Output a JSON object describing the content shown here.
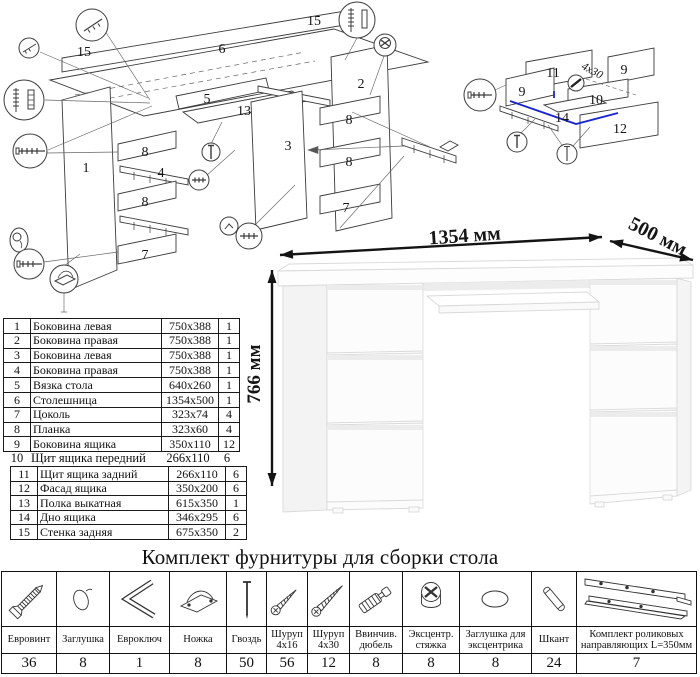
{
  "main_diagram": {
    "labels": [
      "15",
      "6",
      "15",
      "1",
      "8",
      "4",
      "8",
      "7",
      "5",
      "13",
      "3",
      "2",
      "8",
      "8",
      "7"
    ]
  },
  "drawer_diagram": {
    "labels": [
      "9",
      "11",
      "9",
      "10",
      "14",
      "12"
    ],
    "screw_note": "4x30"
  },
  "desk": {
    "width_label": "1354 мм",
    "depth_label": "500 мм",
    "height_label": "766 мм"
  },
  "parts_table": {
    "rows": [
      {
        "num": "1",
        "name": "Боковина левая",
        "size": "750x388",
        "qty": "1"
      },
      {
        "num": "2",
        "name": "Боковина правая",
        "size": "750x388",
        "qty": "1"
      },
      {
        "num": "3",
        "name": "Боковина левая",
        "size": "750x388",
        "qty": "1"
      },
      {
        "num": "4",
        "name": "Боковина правая",
        "size": "750x388",
        "qty": "1"
      },
      {
        "num": "5",
        "name": "Вязка стола",
        "size": "640x260",
        "qty": "1"
      },
      {
        "num": "6",
        "name": "Столешница",
        "size": "1354x500",
        "qty": "1"
      },
      {
        "num": "7",
        "name": "Цоколь",
        "size": "323x74",
        "qty": "4"
      },
      {
        "num": "8",
        "name": "Планка",
        "size": "323x60",
        "qty": "4"
      },
      {
        "num": "9",
        "name": "Боковина ящика",
        "size": "350x110",
        "qty": "12"
      },
      {
        "num": "10",
        "name": "Щит ящика передний",
        "size": "266x110",
        "qty": "6"
      },
      {
        "num": "11",
        "name": "Щит ящика задний",
        "size": "266x110",
        "qty": "6"
      },
      {
        "num": "12",
        "name": "Фасад ящика",
        "size": "350x200",
        "qty": "6"
      },
      {
        "num": "13",
        "name": "Полка выкатная",
        "size": "615x350",
        "qty": "1"
      },
      {
        "num": "14",
        "name": "Дно ящика",
        "size": "346x295",
        "qty": "6"
      },
      {
        "num": "15",
        "name": "Стенка задняя",
        "size": "675x350",
        "qty": "2"
      }
    ]
  },
  "hardware_kit": {
    "title": "Комплект фурнитуры для сборки стола",
    "items": [
      {
        "name": "Евровинт",
        "qty": "36",
        "icon": "confirmat-screw-icon"
      },
      {
        "name": "Заглушка",
        "qty": "8",
        "icon": "cap-icon"
      },
      {
        "name": "Евроключ",
        "qty": "1",
        "icon": "hex-key-icon"
      },
      {
        "name": "Ножка",
        "qty": "8",
        "icon": "foot-icon"
      },
      {
        "name": "Гвоздь",
        "qty": "50",
        "icon": "nail-icon"
      },
      {
        "name": "Шуруп 4x16",
        "qty": "56",
        "icon": "screw-4x16-icon"
      },
      {
        "name": "Шуруп 4x30",
        "qty": "12",
        "icon": "screw-4x30-icon"
      },
      {
        "name": "Ввинчив. дюбель",
        "qty": "8",
        "icon": "screw-in-dowel-icon"
      },
      {
        "name": "Эксцентр. стяжка",
        "qty": "8",
        "icon": "eccentric-cam-icon"
      },
      {
        "name": "Заглушка для эксцентрика",
        "qty": "8",
        "icon": "cam-cap-icon"
      },
      {
        "name": "Шкант",
        "qty": "24",
        "icon": "wooden-dowel-icon"
      },
      {
        "name": "Комплект роликовых направляющих L=350мм",
        "qty": "7",
        "icon": "roller-slides-icon"
      }
    ]
  }
}
